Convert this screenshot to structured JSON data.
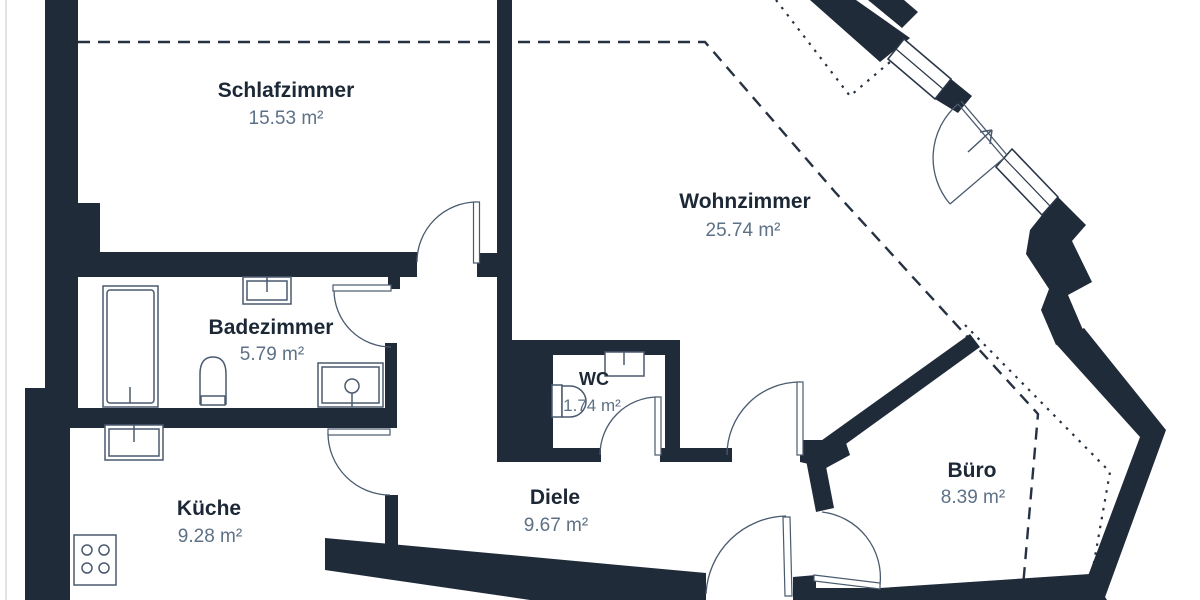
{
  "plan": {
    "type": "apartment-floorplan",
    "wall_color": "#202b3a",
    "accent_text_color": "#5d7186",
    "rooms": [
      {
        "id": "schlafzimmer",
        "name": "Schlafzimmer",
        "area": "15.53 m²"
      },
      {
        "id": "wohnzimmer",
        "name": "Wohnzimmer",
        "area": "25.74 m²"
      },
      {
        "id": "badezimmer",
        "name": "Badezimmer",
        "area": "5.79 m²"
      },
      {
        "id": "wc",
        "name": "WC",
        "area": "1.74 m²"
      },
      {
        "id": "kueche",
        "name": "Küche",
        "area": "9.28 m²"
      },
      {
        "id": "diele",
        "name": "Diele",
        "area": "9.67 m²"
      },
      {
        "id": "buero",
        "name": "Büro",
        "area": "8.39 m²"
      }
    ],
    "fixtures": [
      "bathtub",
      "toilet",
      "sink",
      "radiator",
      "stove",
      "door-swing",
      "window",
      "entrance-arrow"
    ],
    "line_styles": {
      "roof_slope_dashed": "long-dash",
      "knee_wall_dotted": "fine-dot"
    }
  }
}
